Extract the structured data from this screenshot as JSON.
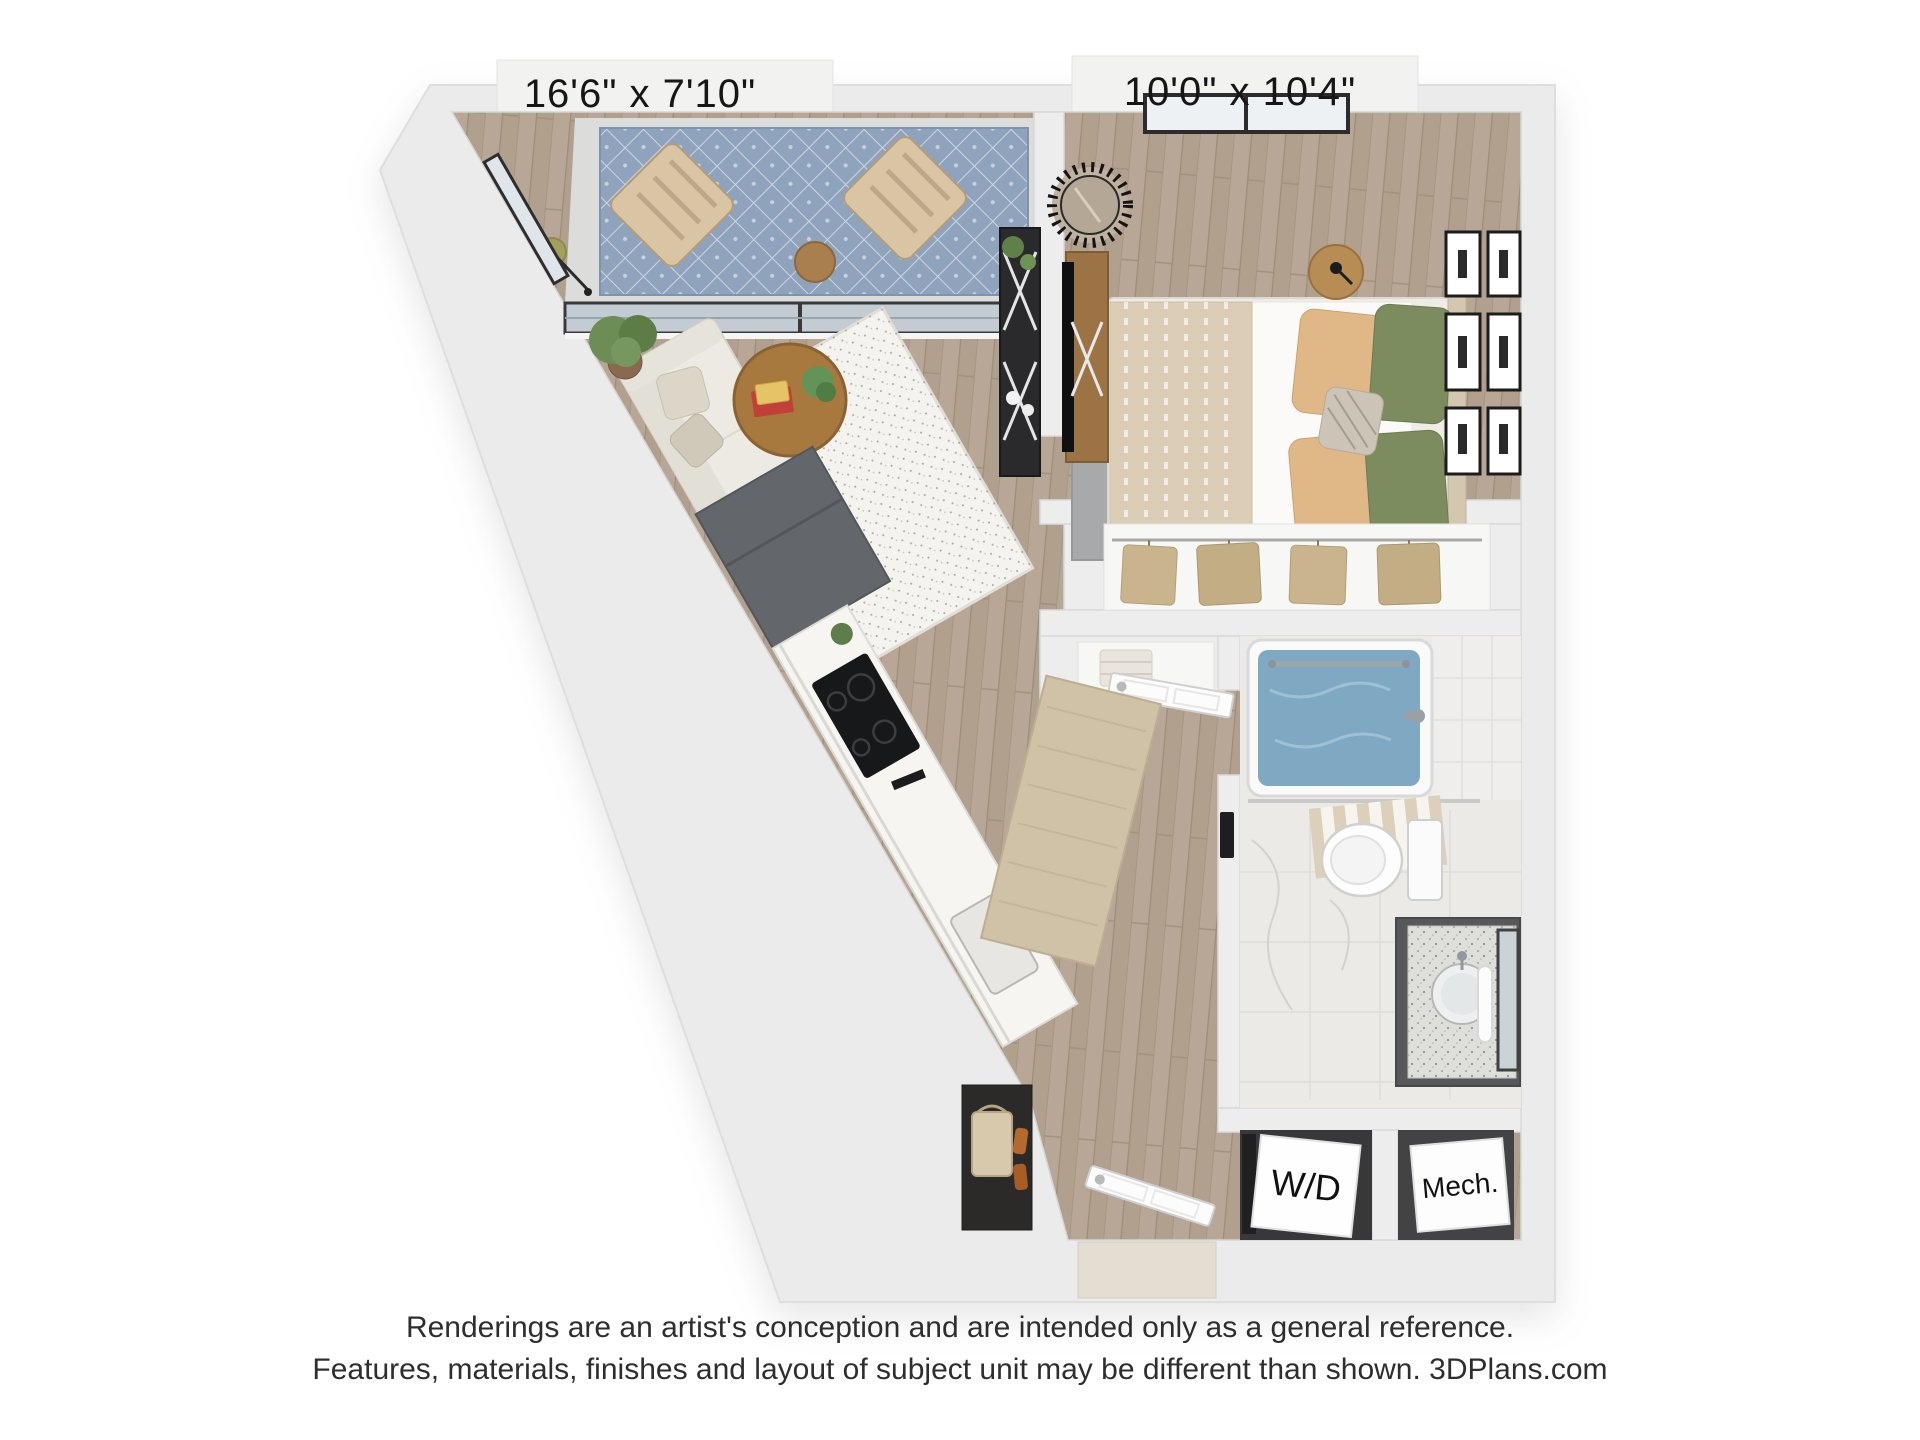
{
  "floorplan": {
    "labels": {
      "living_area_dims": "16'6\" x 7'10\"",
      "bedroom_dims": "10'0\" x 10'4\"",
      "washer_dryer": "W/D",
      "mechanical": "Mech."
    },
    "colors": {
      "wall": "#ebebeb",
      "floor_wood": "#b8a796",
      "balcony_rug": "#8fa3bd",
      "bath_water": "#7fa9c3",
      "bedroom_rug": "#a7a9ab",
      "pillow_green": "#7c8c5f",
      "pillow_tan": "#e0b787",
      "coffee_table_wood": "#a8793f",
      "console_wood": "#9b7344",
      "nightstand_wood": "#b78d55",
      "appliance_dark": "#63666a",
      "shelf_black": "#2a2a2c",
      "runner_rug": "#cfc2a6",
      "garment_tan": "#c9b48d"
    }
  },
  "disclaimer": {
    "line1": "Renderings are an artist's conception and are intended only as a general reference.",
    "line2": "Features, materials, finishes and layout of subject unit may be different than shown. 3DPlans.com"
  }
}
